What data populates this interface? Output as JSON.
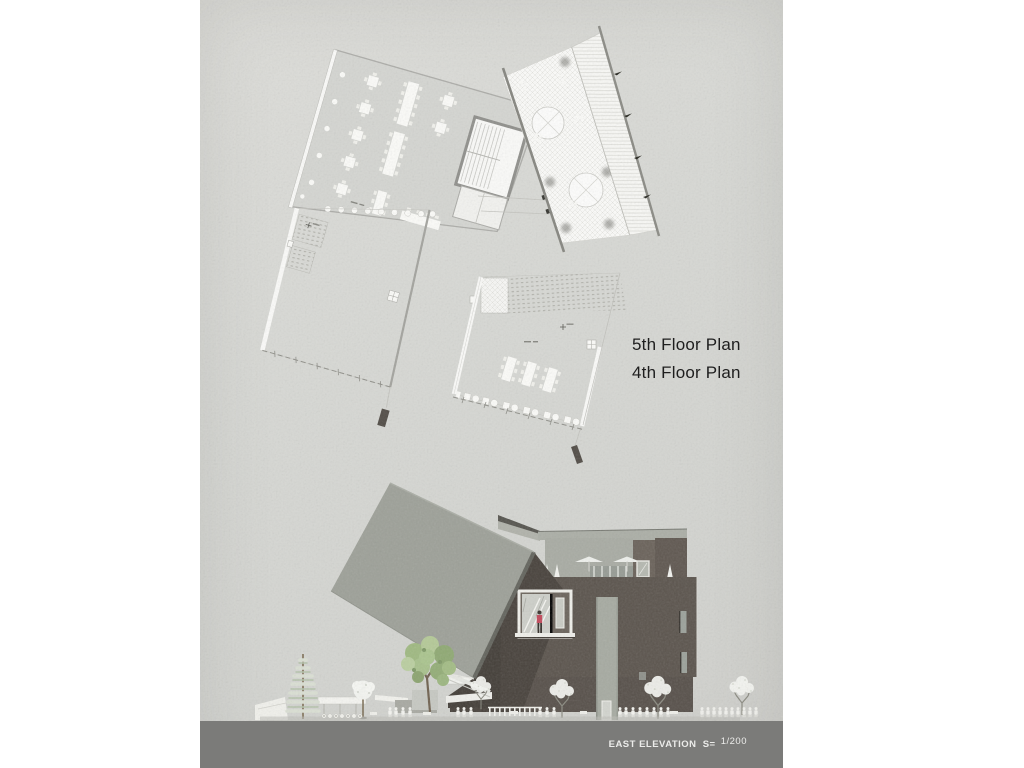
{
  "sheet": {
    "labels": {
      "floor5": "5th Floor Plan",
      "floor4": "4th Floor Plan"
    },
    "footer": {
      "title": "EAST ELEVATION",
      "scale_eq": "S=",
      "scale_value": "1/200"
    },
    "colors": {
      "paper": "#d7d8d4",
      "footer_band": "#7b7b79",
      "footer_text": "#ececea",
      "label_text": "#1e1e1e",
      "building_dark": "#5b544d",
      "tilted_plane": "#9da098",
      "tree_green": "#9fb981",
      "person_accent": "#c2485a"
    }
  }
}
